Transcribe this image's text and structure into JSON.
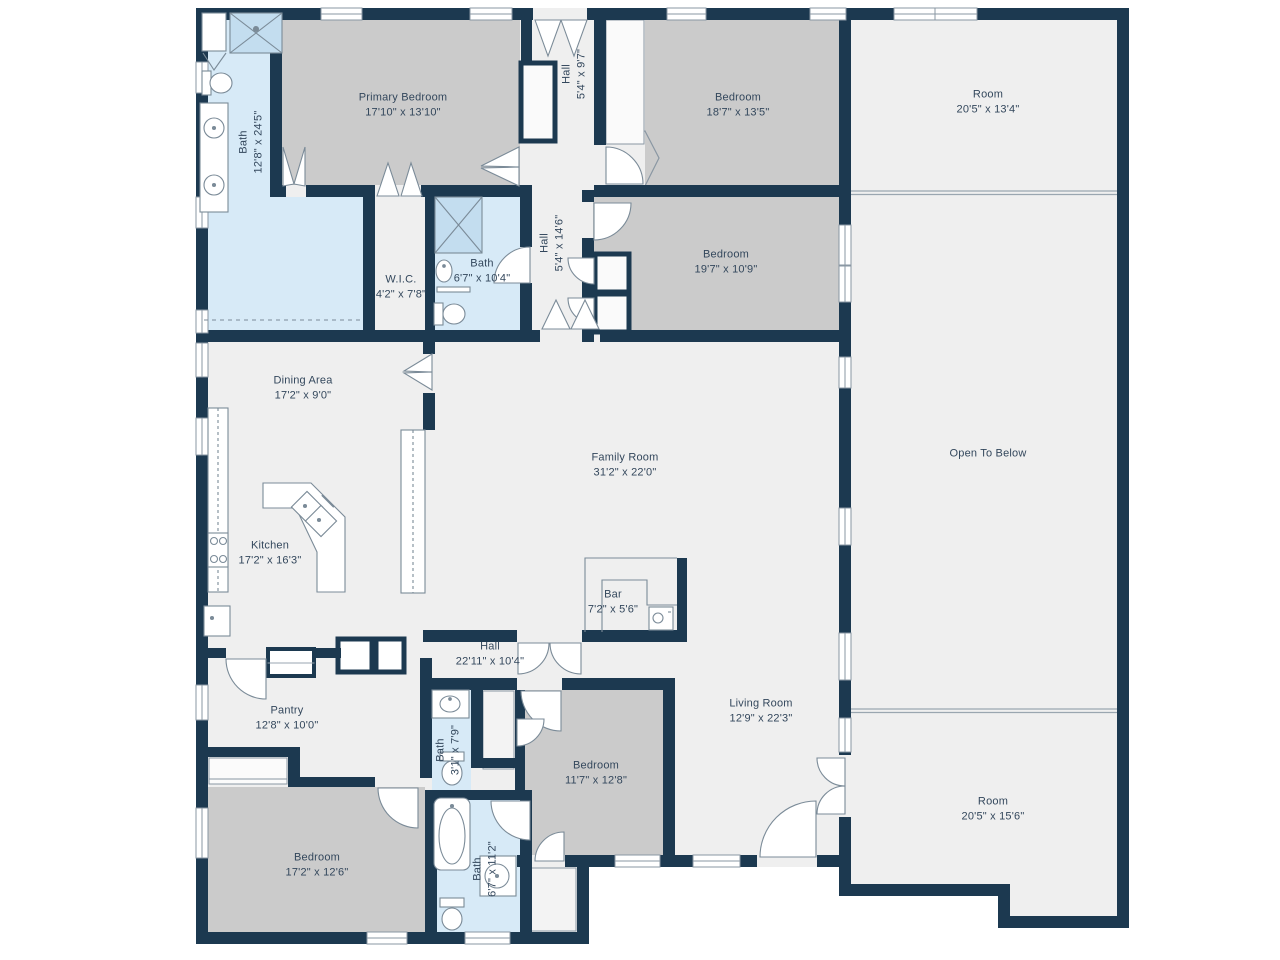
{
  "colors": {
    "wall": "#1c3950",
    "floor": "#efefef",
    "bedroom_floor": "#cbcbcb",
    "bath_floor": "#d7eaf7",
    "shower": "#c3ddef",
    "fixture_line": "#7b8b98",
    "label_text": "#33475c"
  },
  "rooms": {
    "bath_primary": {
      "name": "Bath",
      "dims": "12'8\" x 24'5\""
    },
    "primary_bedroom": {
      "name": "Primary Bedroom",
      "dims": "17'10\" x 13'10\""
    },
    "hall_upper": {
      "name": "Hall",
      "dims": "5'4\" x 9'7\""
    },
    "bedroom_ne": {
      "name": "Bedroom",
      "dims": "18'7\" x 13'5\""
    },
    "room_upper": {
      "name": "Room",
      "dims": "20'5\" x 13'4\""
    },
    "hall_mid": {
      "name": "Hall",
      "dims": "5'4\" x 14'6\""
    },
    "bedroom_e": {
      "name": "Bedroom",
      "dims": "19'7\" x 10'9\""
    },
    "wic": {
      "name": "W.I.C.",
      "dims": "4'2\" x 7'8\""
    },
    "bath_hall": {
      "name": "Bath",
      "dims": "6'7\" x 10'4\""
    },
    "dining": {
      "name": "Dining Area",
      "dims": "17'2\" x 9'0\""
    },
    "family": {
      "name": "Family Room",
      "dims": "31'2\" x 22'0\""
    },
    "open_below": {
      "name": "Open To Below"
    },
    "kitchen": {
      "name": "Kitchen",
      "dims": "17'2\" x 16'3\""
    },
    "bar": {
      "name": "Bar",
      "dims": "7'2\" x 5'6\""
    },
    "hall_lower": {
      "name": "Hall",
      "dims": "22'11\" x 10'4\""
    },
    "pantry": {
      "name": "Pantry",
      "dims": "12'8\" x 10'0\""
    },
    "bath_small": {
      "name": "Bath",
      "dims": "3'1\" x 7'9\""
    },
    "bedroom_s": {
      "name": "Bedroom",
      "dims": "11'7\" x 12'8\""
    },
    "living": {
      "name": "Living Room",
      "dims": "12'9\" x 22'3\""
    },
    "room_lower": {
      "name": "Room",
      "dims": "20'5\" x 15'6\""
    },
    "bedroom_sw": {
      "name": "Bedroom",
      "dims": "17'2\" x 12'6\""
    },
    "bath_sw": {
      "name": "Bath",
      "dims": "6'7\" x 11'2\""
    }
  }
}
